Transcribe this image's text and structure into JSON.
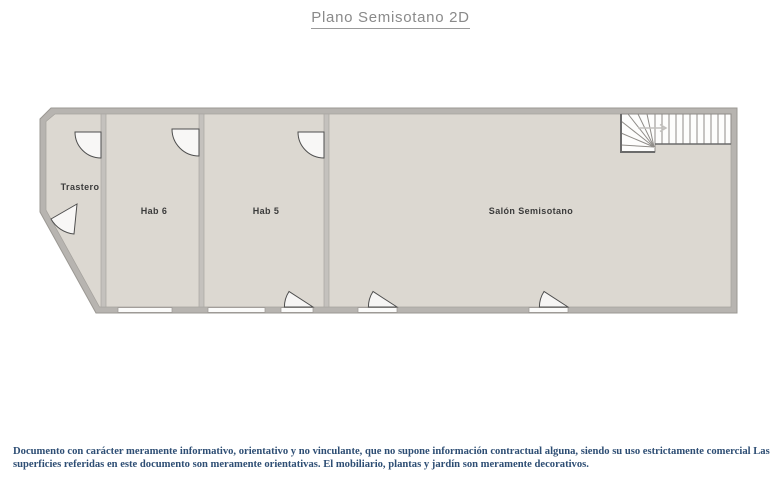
{
  "title": {
    "text": "Plano Semisotano 2D"
  },
  "floorplan": {
    "rooms": [
      {
        "label": "Trastero"
      },
      {
        "label": "Hab 6"
      },
      {
        "label": "Hab 5"
      },
      {
        "label": "Salón Semisotano"
      }
    ],
    "features": {
      "stairs": "l-shaped-staircase-with-winders",
      "doors": 4,
      "window_openings": 5
    },
    "colors": {
      "floor": "#dcd8d1",
      "outer_wall": "#b7b4b0",
      "partition_wall": "#c4c1bd",
      "door_stroke": "#4e4e4e",
      "title_text": "#8a8a8a",
      "label_text": "#3b3b3b",
      "disclaimer_text": "#2e4e74",
      "background": "#ffffff"
    }
  },
  "disclaimer": {
    "lines": [
      "Documento con carácter meramente informativo, orientativo y no vinculante, que no supone información contractual alguna, siendo su uso estrictamente comercial Las",
      "superficies referidas en este documento son meramente orientativas. El mobiliario, plantas y jardín son meramente decorativos."
    ]
  }
}
